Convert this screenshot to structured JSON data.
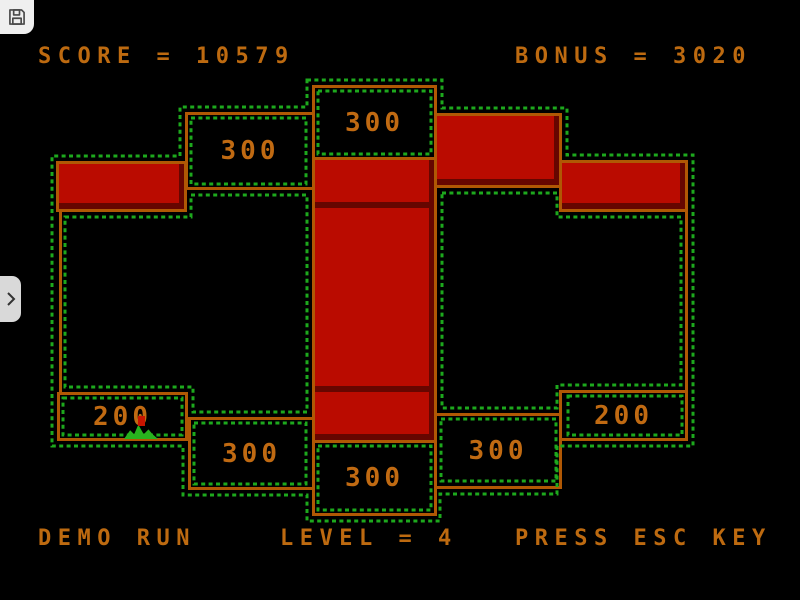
{
  "chrome": {
    "save_button": {
      "icon": "floppy-disk-icon"
    },
    "sidebar_toggle": {
      "icon": "chevron-right-icon"
    }
  },
  "hud": {
    "score_text": "SCORE = 10579",
    "bonus_text": "BONUS = 3020",
    "demo_text": "DEMO RUN",
    "level_text": "LEVEL = 4",
    "esc_text": "PRESS ESC KEY"
  },
  "board": {
    "score_boxes": [
      {
        "name": "top-left",
        "value": "300"
      },
      {
        "name": "top-center",
        "value": "300"
      },
      {
        "name": "bottom-far-left",
        "value": "200"
      },
      {
        "name": "bottom-left",
        "value": "300"
      },
      {
        "name": "bottom-center",
        "value": "300"
      },
      {
        "name": "bottom-right",
        "value": "300"
      },
      {
        "name": "bottom-far-right",
        "value": "200"
      }
    ],
    "filled_block_count": 6,
    "player_marker": "green-splat-with-red-chip"
  },
  "colors": {
    "background": "#000000",
    "border_orange": "#b05804",
    "text_orange": "#bd6a10",
    "block_red": "#ba0b00",
    "dot_green": "#1da81d",
    "chrome_gray": "#e9e9e9"
  }
}
